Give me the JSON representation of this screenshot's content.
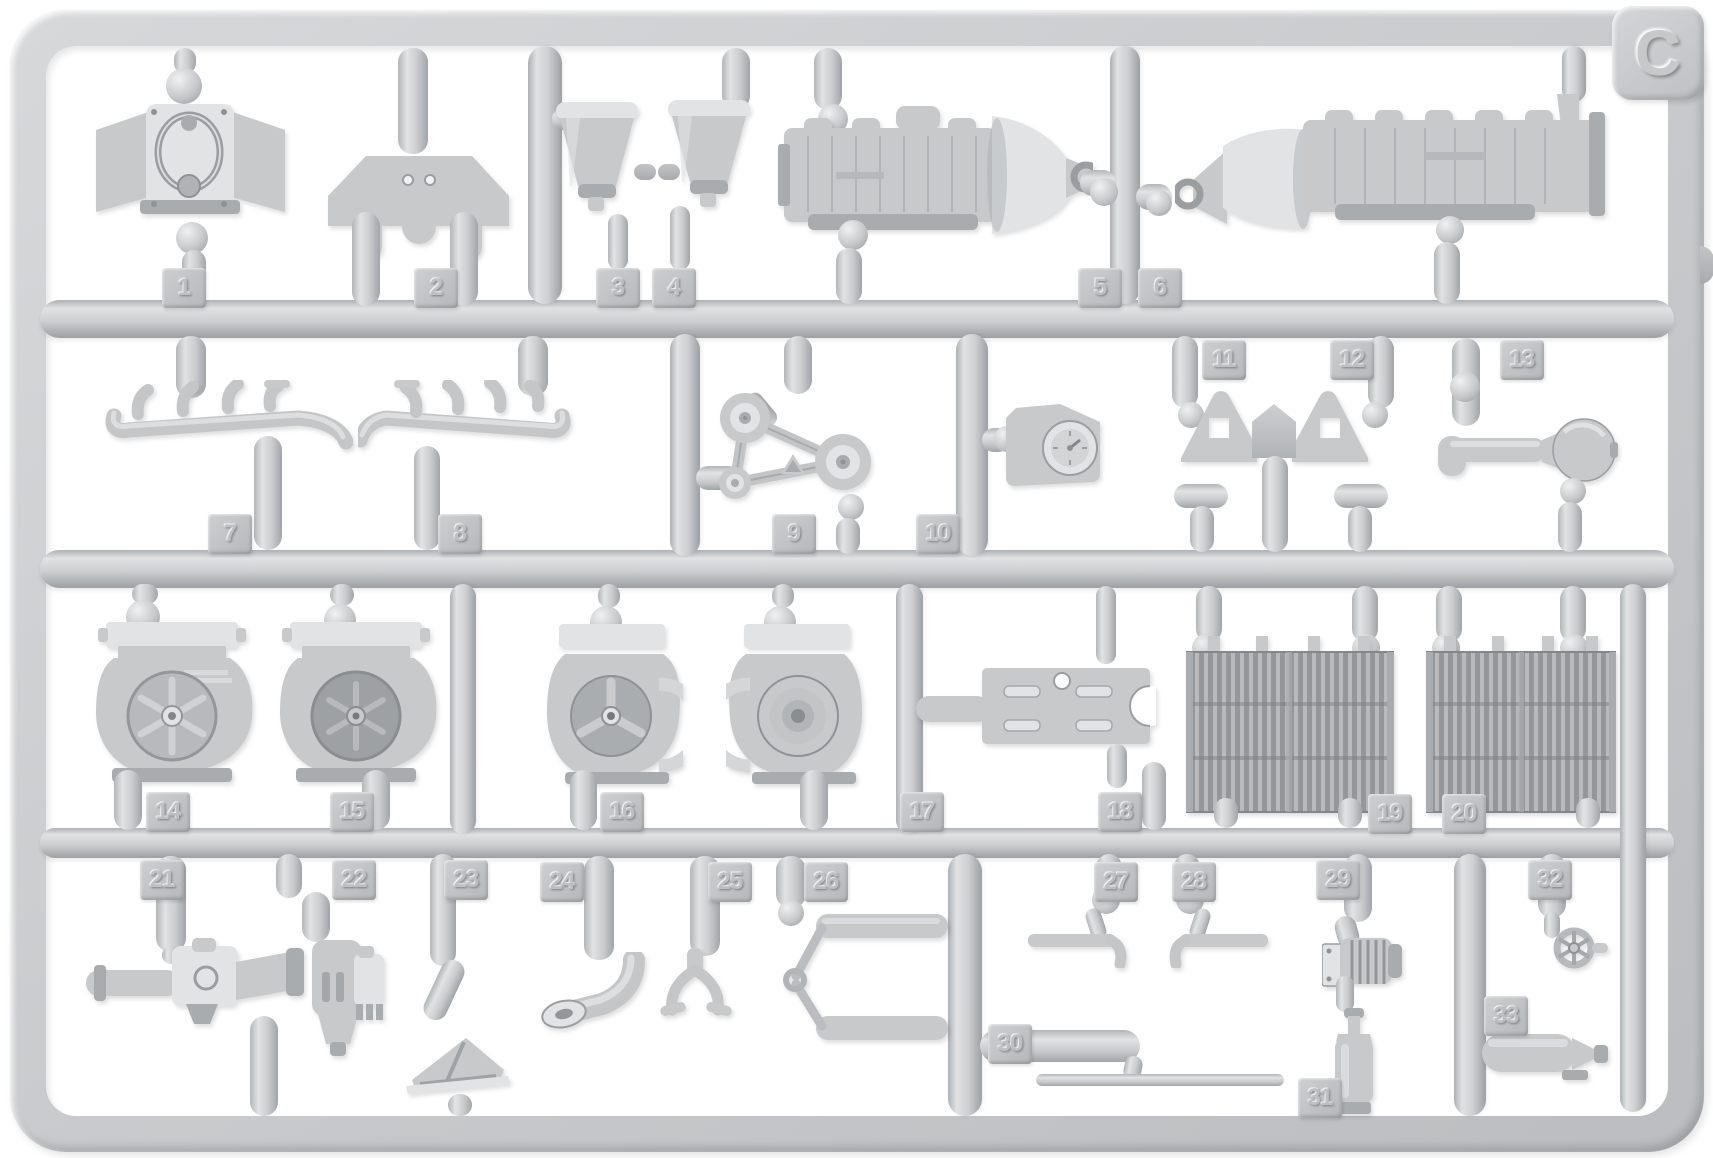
{
  "sprue": {
    "letter": "C",
    "plastic_color": "#c9cbcd",
    "background_color": "#ffffff",
    "part_count": 33
  },
  "part_tags": [
    {
      "number": "1",
      "name": "engine-timing-cover"
    },
    {
      "number": "2",
      "name": "engine-mounting-plate"
    },
    {
      "number": "3",
      "name": "intake-funnel-left"
    },
    {
      "number": "4",
      "name": "intake-funnel-right"
    },
    {
      "number": "5",
      "name": "engine-block-with-gearbox-left"
    },
    {
      "number": "6",
      "name": "engine-block-with-gearbox-right"
    },
    {
      "number": "7",
      "name": "exhaust-manifold-left"
    },
    {
      "number": "8",
      "name": "exhaust-manifold-right"
    },
    {
      "number": "9",
      "name": "fan-belt-with-pulleys"
    },
    {
      "number": "10",
      "name": "pulley-bracket"
    },
    {
      "number": "11",
      "name": "engine-mount-bracket-left"
    },
    {
      "number": "12",
      "name": "engine-mount-bracket-right"
    },
    {
      "number": "13",
      "name": "air-cleaner-drum"
    },
    {
      "number": "14",
      "name": "fan-housing-a"
    },
    {
      "number": "15",
      "name": "fan-housing-b"
    },
    {
      "number": "16",
      "name": "fan-housing-c"
    },
    {
      "number": "17",
      "name": "fan-housing-d"
    },
    {
      "number": "18",
      "name": "mounting-plate"
    },
    {
      "number": "19",
      "name": "radiator-core-left"
    },
    {
      "number": "20",
      "name": "radiator-core-right"
    },
    {
      "number": "21",
      "name": "carburetor-assembly"
    },
    {
      "number": "22",
      "name": "fuel-pump"
    },
    {
      "number": "23",
      "name": "angled-support-bracket"
    },
    {
      "number": "24",
      "name": "filler-elbow-pipe"
    },
    {
      "number": "25",
      "name": "clutch-fork"
    },
    {
      "number": "26",
      "name": "control-linkage"
    },
    {
      "number": "27",
      "name": "hand-lever-left"
    },
    {
      "number": "28",
      "name": "hand-lever-right"
    },
    {
      "number": "29",
      "name": "oil-filter"
    },
    {
      "number": "30",
      "name": "tie-rod"
    },
    {
      "number": "31",
      "name": "grease-pump-bottle"
    },
    {
      "number": "32",
      "name": "valve-handwheel"
    },
    {
      "number": "33",
      "name": "air-tank"
    }
  ]
}
